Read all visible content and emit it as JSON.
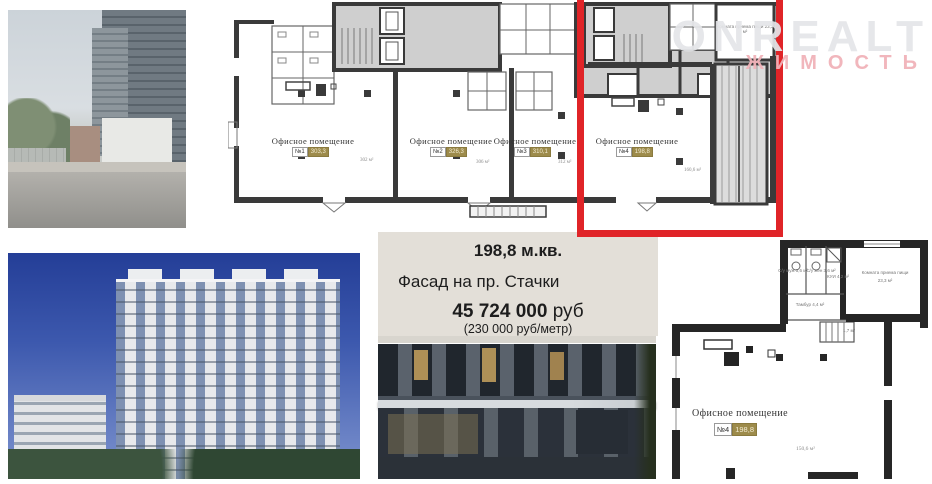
{
  "watermark": {
    "brand": "ONREALT",
    "sub": "ЖИМОСТЬ"
  },
  "info_box": {
    "area": "198,8 м.кв.",
    "facade": "Фасад на пр. Стачки",
    "price": "45 724 000",
    "price_currency": "руб",
    "price_per_meter": "(230 000 руб/метр)"
  },
  "floorplan_main": {
    "offices": [
      {
        "label": "Офисное помещение",
        "number": "№1",
        "badge": "303,3",
        "area_note": "302 м²"
      },
      {
        "label": "Офисное помещение",
        "number": "№2",
        "badge": "326,3",
        "area_note": "306 м²"
      },
      {
        "label": "Офисное помещение",
        "number": "№3",
        "badge": "310,1",
        "area_note": "312 м²"
      },
      {
        "label": "Офисное помещение",
        "number": "№4",
        "badge": "198,8",
        "area_note": "160,6 м²"
      }
    ],
    "room_note": "Комната приема пищи 23,3 м²"
  },
  "floorplan_detail": {
    "label": "Офисное помещение",
    "number": "№4",
    "badge": "198,8",
    "area_note": "150,6 м²",
    "rooms": {
      "wc_m": "С/у муж 3,6 м²",
      "wc_f": "С/у жен 3,6 м²",
      "kui": "КУИ 4,2 м²",
      "tambur": "Тамбур 4,4 м²",
      "stairs": "1,7 м²",
      "dining": "Комната приема пищи",
      "dining_area": "23,3 м²"
    }
  },
  "colors": {
    "accent_red": "#e02428",
    "badge_gold": "#9d8b4b",
    "info_bg": "#e3dfd8",
    "watermark_pink": "#f0b2b8"
  }
}
